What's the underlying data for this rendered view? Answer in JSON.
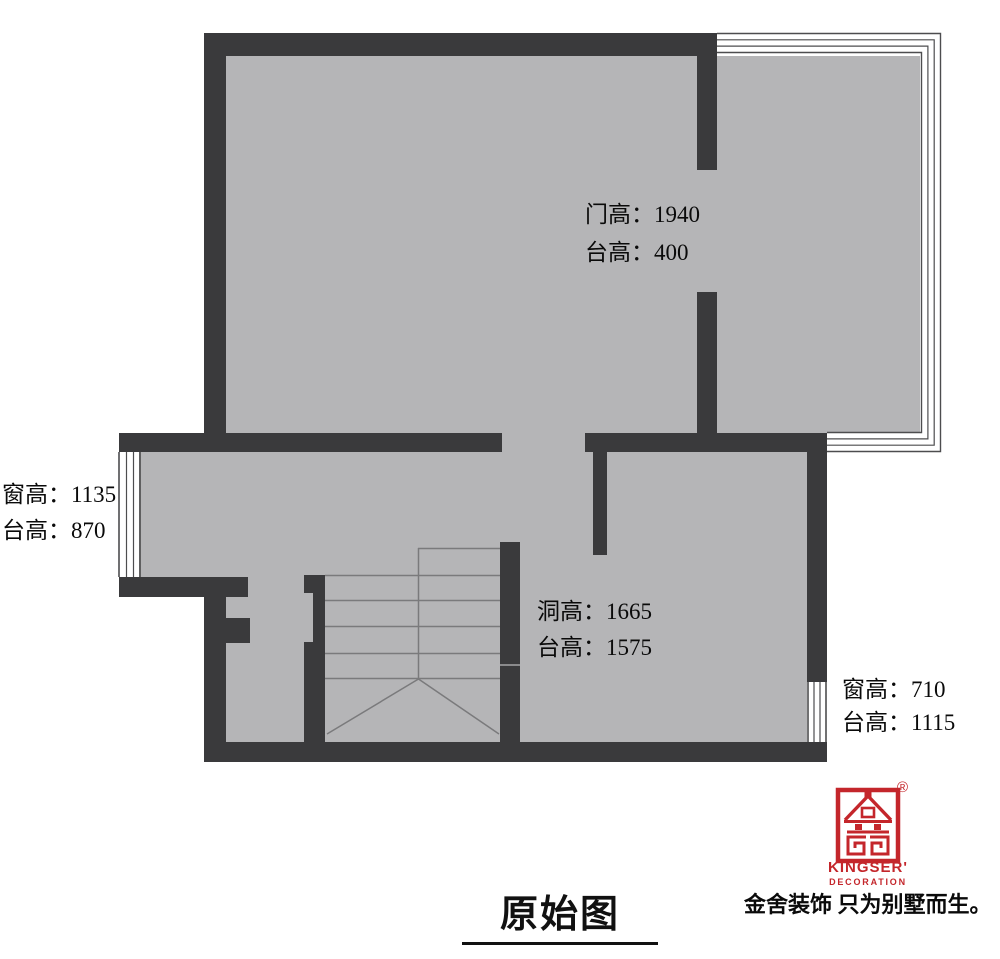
{
  "plan_title": "原始图",
  "labels": {
    "door": {
      "line1": "门高：1940",
      "line2": "台高：400"
    },
    "west_window": {
      "line1": "窗高：1135",
      "line2": "台高：870"
    },
    "stair_opening": {
      "line1": "洞高：1665",
      "line2": "台高：1575"
    },
    "east_window": {
      "line1": "窗高：710",
      "line2": "台高：1115"
    }
  },
  "branding": {
    "logo_text": "KINGSER'",
    "logo_subtext": "DECORATION",
    "registered_mark": "®",
    "tagline": "金舍装饰 只为别墅而生。"
  },
  "colors": {
    "wall": "#3a3a3c",
    "floor": "#b5b5b7",
    "window_line": "#4d4d4f",
    "stair_line": "#7a7a7c",
    "brand_red": "#c4262b",
    "text": "#0a0a0a"
  }
}
